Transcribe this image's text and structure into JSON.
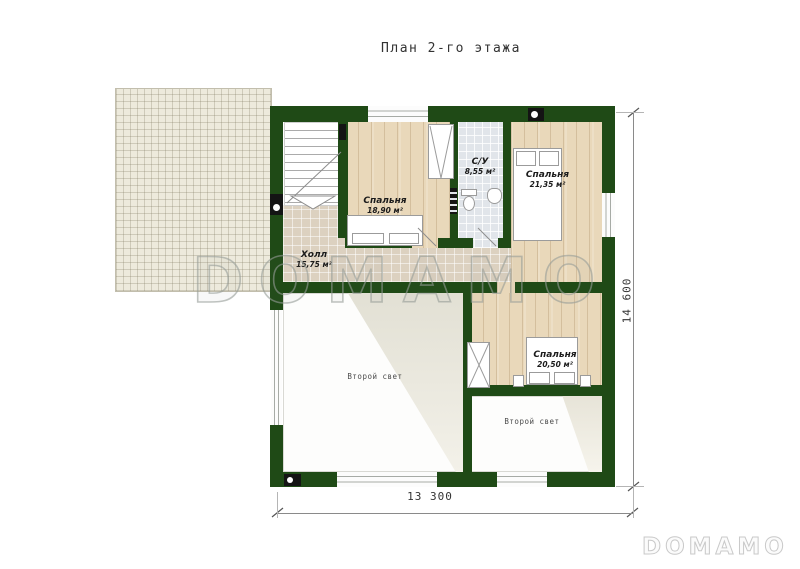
{
  "title": "План 2-го этажа",
  "watermark_text": "DOMAMO",
  "logo_text": "DOMAMO",
  "rooms": {
    "bedroom_top_left": {
      "name": "Спальня",
      "area": "18,90 м²"
    },
    "bathroom": {
      "name": "С/У",
      "area": "8,55 м²"
    },
    "bedroom_top_right": {
      "name": "Спальня",
      "area": "21,35 м²"
    },
    "hall": {
      "name": "Холл",
      "area": "15,75 м²"
    },
    "bedroom_right": {
      "name": "Спальня",
      "area": "20,50 м²"
    },
    "void_left": {
      "name": "Второй свет"
    },
    "void_right": {
      "name": "Второй свет"
    }
  },
  "dimensions": {
    "horizontal": "13 300",
    "vertical": "14 600"
  },
  "colors": {
    "wall": "#1f4a16",
    "wood_floor": "#e9d8ba",
    "hall_tile": "#dcd1c0",
    "bath_tile": "#e1e5ea",
    "roof_grid": "#edeadc",
    "watermark": "#9aa09c"
  }
}
